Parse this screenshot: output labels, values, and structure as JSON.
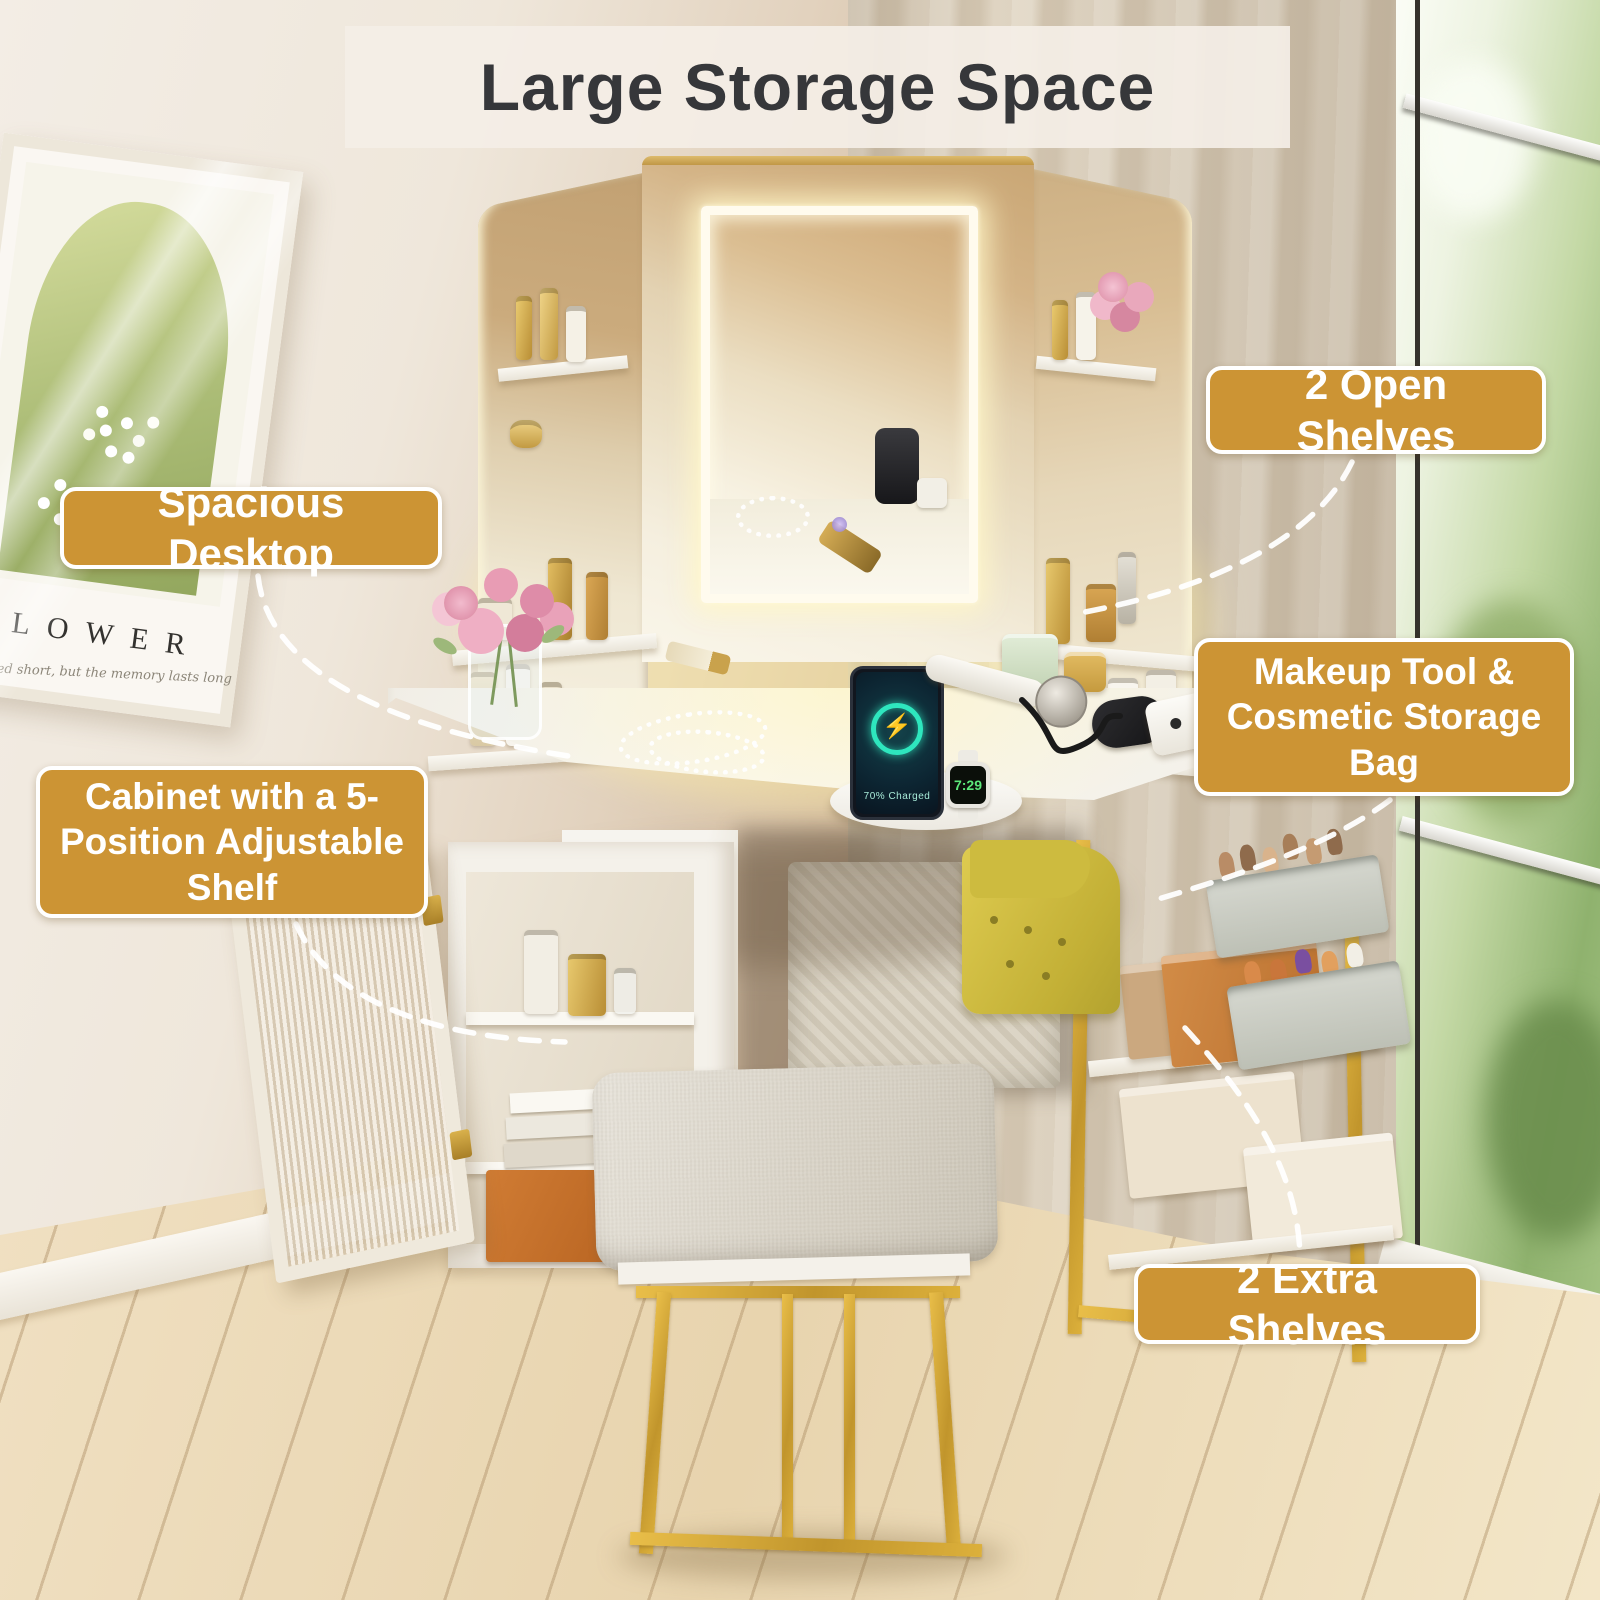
{
  "banner": {
    "title": "Large Storage Space"
  },
  "callouts": [
    {
      "id": "open-shelves",
      "label": "2 Open Shelves"
    },
    {
      "id": "spacious-desktop",
      "label": "Spacious Desktop"
    },
    {
      "id": "makeup-storage-bag",
      "label": "Makeup Tool & Cosmetic Storage Bag"
    },
    {
      "id": "cabinet-adjustable-shelf",
      "label": "Cabinet with a 5-Position Adjustable Shelf"
    },
    {
      "id": "extra-shelves",
      "label": "2 Extra Shelves"
    }
  ],
  "artwork": {
    "title": "FLOWER",
    "caption": "remained short, but the memory lasts long"
  },
  "devices": {
    "phone_status": "70% Charged",
    "watch_time": "7:29"
  },
  "icons": {
    "charging_bolt": "⚡"
  },
  "colors": {
    "callout_bg": "#CC9434",
    "callout_text": "#FFFFFF",
    "banner_bg": "#F4EEE6",
    "banner_text": "#36373A",
    "gold_metal": "#D8A834",
    "led_white": "#FFFBEA"
  }
}
